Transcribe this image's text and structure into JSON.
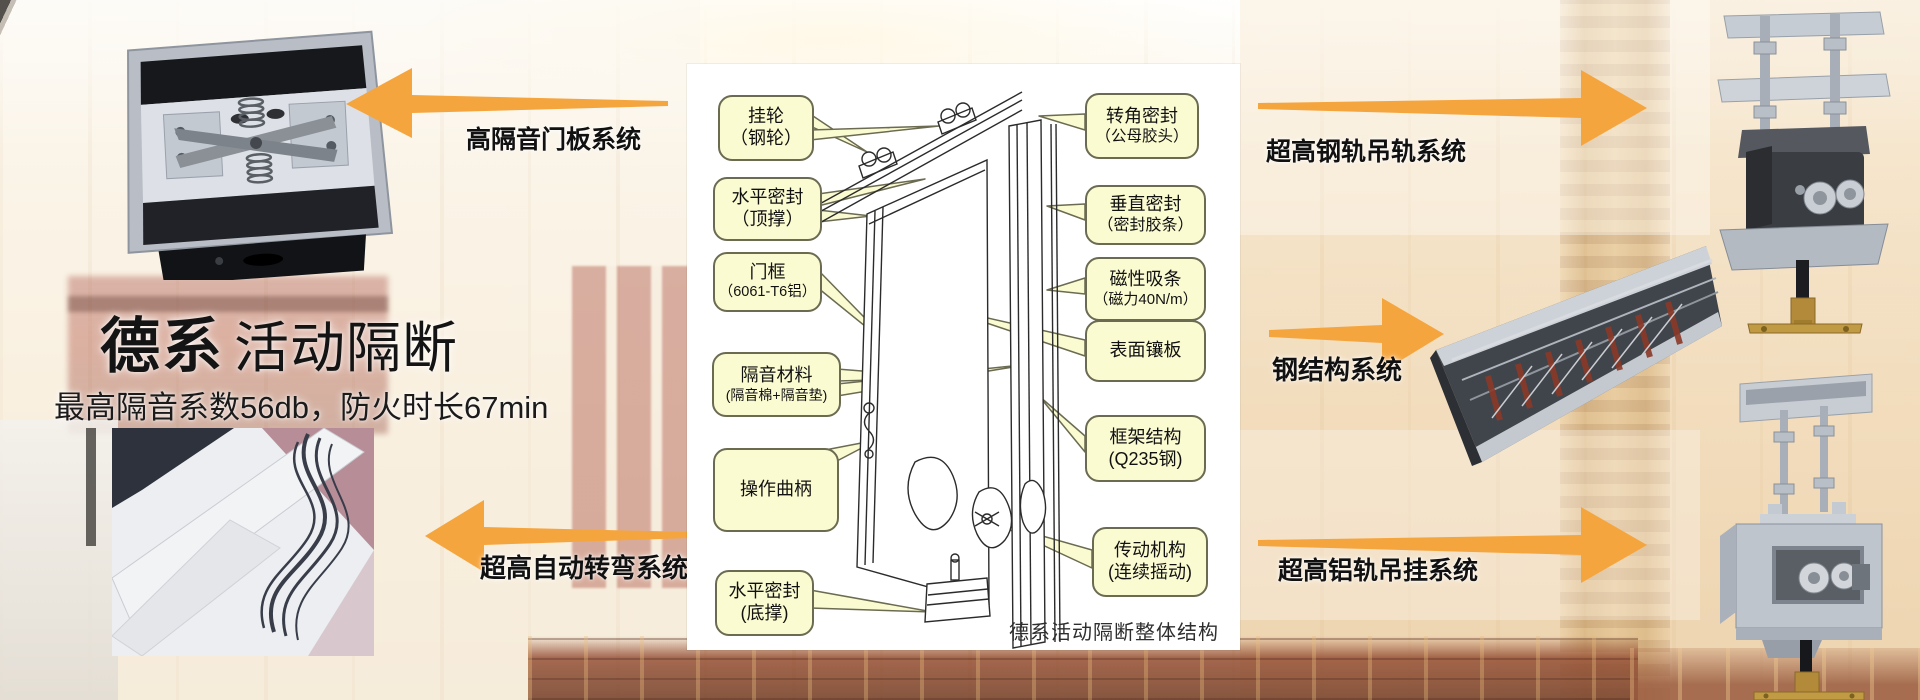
{
  "colors": {
    "arrow_orange": "#F5A53E",
    "callout_fill": "#FBFBD2",
    "callout_border": "#6B6B52",
    "carpet_brown": "#7D4A34",
    "panel_white": "#FFFFFF"
  },
  "hero": {
    "title_primary": "德系",
    "title_secondary": "活动隔断",
    "subtitle": "最高隔音系数56db，防火时长67min"
  },
  "system_labels": {
    "door_panel": "高隔音门板系统",
    "auto_turn": "超高自动转弯系统",
    "steel_rail": "超高钢轨吊轨系统",
    "steel_structure": "钢结构系统",
    "aluminum_rail": "超高铝轨吊挂系统"
  },
  "diagram": {
    "caption": "德系活动隔断整体结构",
    "left_labels": [
      {
        "line1": "挂轮",
        "line2": "（钢轮）"
      },
      {
        "line1": "水平密封",
        "line2": "（顶撑）"
      },
      {
        "line1": "门框",
        "line2": "（6061-T6铝）"
      },
      {
        "line1": "隔音材料",
        "line2": "(隔音棉+隔音垫)"
      },
      {
        "line1": "操作曲柄",
        "line2": ""
      },
      {
        "line1": "水平密封",
        "line2": "(底撑)"
      }
    ],
    "right_labels": [
      {
        "line1": "转角密封",
        "line2": "（公母胶头）"
      },
      {
        "line1": "垂直密封",
        "line2": "（密封胶条）"
      },
      {
        "line1": "磁性吸条",
        "line2": "（磁力40N/m）"
      },
      {
        "line1": "表面镶板",
        "line2": ""
      },
      {
        "line1": "框架结构",
        "line2": "(Q235钢)"
      },
      {
        "line1": "传动机构",
        "line2": "(连续摇动)"
      }
    ]
  }
}
